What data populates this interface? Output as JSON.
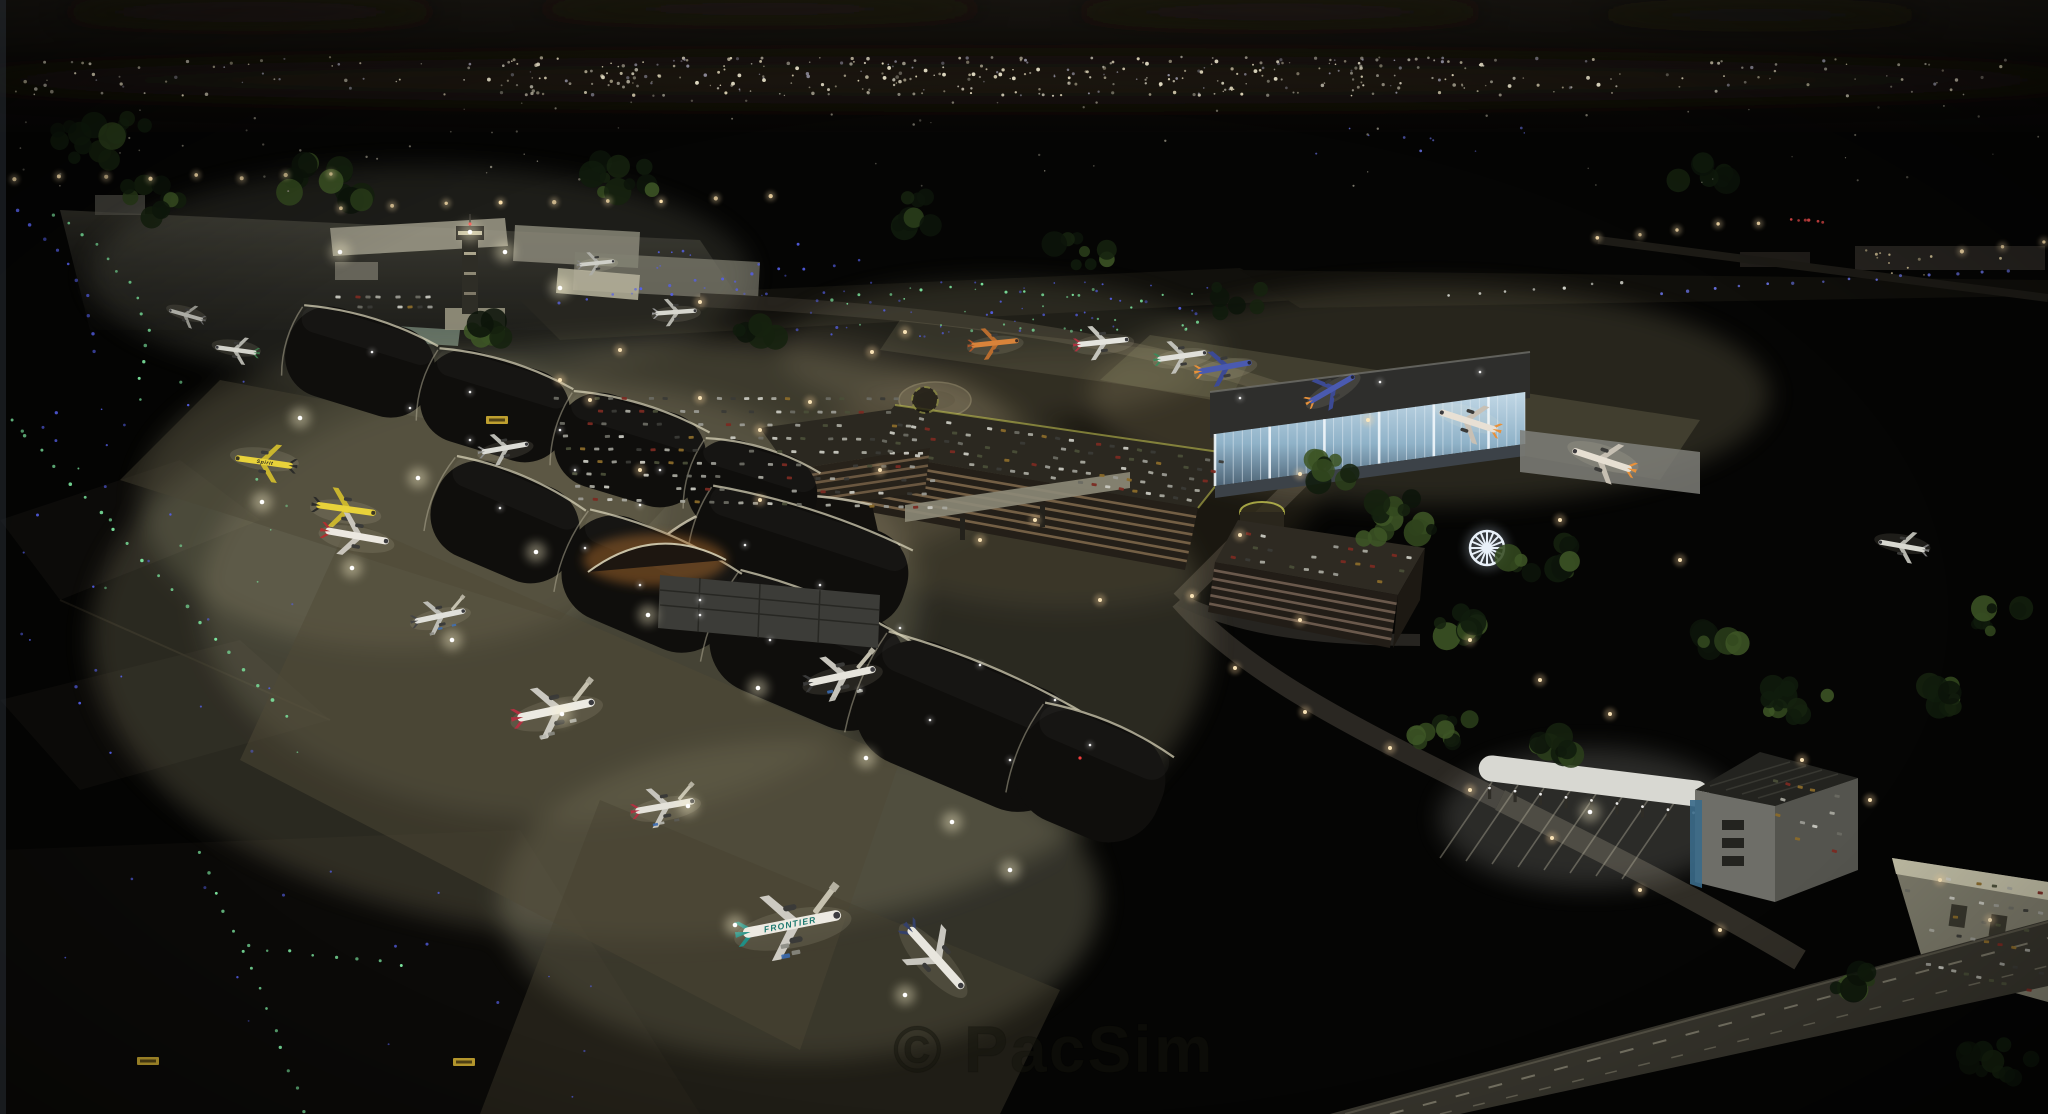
{
  "watermark": {
    "text": "© PacSim"
  },
  "labels": {
    "frontier": "FRONTIER",
    "spirit": "Spirit"
  },
  "palette": {
    "sky_top": "#1b1813",
    "sky": "#0a0907",
    "ground": "#050504",
    "apron_glow": "#d9d2a2",
    "taxi_green": "#7de8a0",
    "taxi_blue": "#5560e8",
    "warm_light": "#ffe3ae",
    "city_warm": "#efe6c8",
    "city_cool": "#b9b5a6",
    "roof_dark": "#0f0e0c",
    "roof_rib": "#d6d0b6",
    "garage_band": "#b5946a",
    "garage_trim": "#c6c650",
    "glass_blue": "#a9c6da",
    "red_light": "#e04848"
  },
  "scene": {
    "city_band": {
      "y_min": 57,
      "y_max": 96,
      "count": 430
    },
    "aircraft": [
      {
        "name": "spirit-a320-remote",
        "x": 264,
        "y": 462,
        "rot": 188,
        "len": 56,
        "body": "#e8d23a",
        "tail": "#2a2a28",
        "wing": "#c9b52e",
        "label": "Spirit",
        "label_color": "#1a1a1a"
      },
      {
        "name": "white-regional-upper",
        "x": 505,
        "y": 448,
        "rot": -10,
        "len": 46,
        "body": "#dcdcd6",
        "tail": "#8a8a88",
        "wing": "#b9b9b2"
      },
      {
        "name": "spirit-a320-gate",
        "x": 346,
        "y": 509,
        "rot": 8,
        "len": 58,
        "body": "#e8d23a",
        "tail": "#2a2a28",
        "wing": "#c9b52e"
      },
      {
        "name": "retro-red-737",
        "x": 357,
        "y": 536,
        "rot": 10,
        "len": 62,
        "body": "#ece8e0",
        "tail": "#b03030",
        "wing": "#c9c5bc"
      },
      {
        "name": "regional-gate-a",
        "x": 440,
        "y": 616,
        "rot": -12,
        "len": 50,
        "body": "#e0e0da",
        "tail": "#444444",
        "wing": "#bdbdb6",
        "bridge": -38
      },
      {
        "name": "delta-737",
        "x": 556,
        "y": 710,
        "rot": -12,
        "len": 76,
        "body": "#eceae2",
        "tail": "#b03040",
        "wing": "#cac8c0",
        "bridge": -40
      },
      {
        "name": "delta-crj",
        "x": 665,
        "y": 806,
        "rot": -10,
        "len": 58,
        "body": "#e4e2da",
        "tail": "#b03040",
        "wing": "#c6c4bc",
        "bridge": -40
      },
      {
        "name": "frontier-a321",
        "x": 792,
        "y": 924,
        "rot": -11,
        "len": 96,
        "body": "#edeae2",
        "tail": "#1f8f86",
        "wing": "#cdcac2",
        "label": "FRONTIER",
        "label_color": "#1e7a70",
        "bridge": -42
      },
      {
        "name": "gate-widebody-dark-tail",
        "x": 842,
        "y": 676,
        "rot": -12,
        "len": 66,
        "body": "#e6e4dc",
        "tail": "#3a3a3a",
        "wing": "#c6c4bc",
        "bridge": -38
      },
      {
        "name": "pushback-jet",
        "x": 936,
        "y": 958,
        "rot": 48,
        "len": 78,
        "body": "#e8e6de",
        "tail": "#34406a",
        "wing": "#c8c6be"
      },
      {
        "name": "cargo-jet-west-1",
        "x": 186,
        "y": 315,
        "rot": 196,
        "len": 34,
        "body": "#b8b8b0",
        "tail": "#666666",
        "wing": "#9a9a92"
      },
      {
        "name": "cargo-jet-west-2",
        "x": 236,
        "y": 350,
        "rot": 188,
        "len": 40,
        "body": "#d4d4cc",
        "tail": "#3a7a4a",
        "wing": "#b2b2aa"
      },
      {
        "name": "remote-jet-north-1",
        "x": 597,
        "y": 263,
        "rot": -6,
        "len": 34,
        "body": "#cfcfc8",
        "tail": "#888888",
        "wing": "#adada6"
      },
      {
        "name": "remote-jet-north-2",
        "x": 676,
        "y": 312,
        "rot": -4,
        "len": 40,
        "body": "#d6d6ce",
        "tail": "#999999",
        "wing": "#b4b4ac"
      },
      {
        "name": "southwest-gold-737",
        "x": 995,
        "y": 343,
        "rot": -6,
        "len": 46,
        "body": "#d8833a",
        "tail": "#a8542a",
        "wing": "#b86c2e"
      },
      {
        "name": "delta-a320-east",
        "x": 1103,
        "y": 342,
        "rot": -6,
        "len": 50,
        "body": "#e4e4de",
        "tail": "#b03040",
        "wing": "#c4c4bc"
      },
      {
        "name": "green-tail-jet",
        "x": 1182,
        "y": 356,
        "rot": -8,
        "len": 48,
        "body": "#e0e0da",
        "tail": "#3a8a5a",
        "wing": "#c0c0b8"
      },
      {
        "name": "southwest-737-blue-1",
        "x": 1225,
        "y": 367,
        "rot": -10,
        "len": 52,
        "body": "#4a5ab0",
        "tail": "#e8913a",
        "wing": "#3c4a94"
      },
      {
        "name": "southwest-737-blue-2",
        "x": 1332,
        "y": 389,
        "rot": -30,
        "len": 50,
        "body": "#4a5ab0",
        "tail": "#e8913a",
        "wing": "#3c4a94"
      },
      {
        "name": "southwest-737-white-1",
        "x": 1468,
        "y": 421,
        "rot": 198,
        "len": 58,
        "body": "#e8e0d4",
        "tail": "#e8913a",
        "wing": "#c8c0b4"
      },
      {
        "name": "southwest-737-white-2",
        "x": 1602,
        "y": 460,
        "rot": 198,
        "len": 60,
        "body": "#e6dfd2",
        "tail": "#e8913a",
        "wing": "#c6bfb2"
      },
      {
        "name": "remote-jet-east",
        "x": 1902,
        "y": 546,
        "rot": 190,
        "len": 46,
        "body": "#d8d8d0",
        "tail": "#777777",
        "wing": "#b6b6ae"
      }
    ],
    "light_chains": [
      {
        "color": "#7de8a0",
        "r": 1.3,
        "n": 13,
        "pts": [
          [
            55,
            215
          ],
          [
            95,
            245
          ],
          [
            132,
            286
          ],
          [
            148,
            330
          ],
          [
            140,
            378
          ]
        ]
      },
      {
        "color": "#5560e8",
        "r": 1.3,
        "n": 10,
        "pts": [
          [
            18,
            212
          ],
          [
            58,
            252
          ],
          [
            88,
            300
          ],
          [
            94,
            350
          ]
        ]
      },
      {
        "color": "#7de8a0",
        "r": 1.4,
        "n": 20,
        "pts": [
          [
            12,
            420
          ],
          [
            58,
            470
          ],
          [
            118,
            532
          ],
          [
            170,
            588
          ],
          [
            228,
            652
          ],
          [
            288,
            716
          ]
        ]
      },
      {
        "color": "#7de8a0",
        "r": 1.3,
        "n": 14,
        "pts": [
          [
            200,
            852
          ],
          [
            222,
            906
          ],
          [
            248,
            962
          ],
          [
            268,
            1012
          ],
          [
            288,
            1066
          ],
          [
            302,
            1110
          ]
        ]
      },
      {
        "color": "#7de8a0",
        "r": 1.2,
        "n": 8,
        "pts": [
          [
            247,
            947
          ],
          [
            330,
            956
          ],
          [
            402,
            964
          ]
        ]
      },
      {
        "color": "#5560e8",
        "r": 1.2,
        "n": 12,
        "pts": [
          [
            560,
            302
          ],
          [
            660,
            288
          ],
          [
            760,
            272
          ],
          [
            860,
            262
          ]
        ]
      },
      {
        "color": "#7de8a0",
        "r": 1.2,
        "n": 6,
        "pts": [
          [
            830,
            300
          ],
          [
            900,
            292
          ],
          [
            980,
            286
          ]
        ]
      },
      {
        "color": "#6a74e8",
        "r": 1.2,
        "n": 14,
        "pts": [
          [
            1660,
            292
          ],
          [
            1780,
            284
          ],
          [
            1900,
            277
          ],
          [
            2010,
            270
          ]
        ]
      },
      {
        "color": "#cfd0c8",
        "r": 1.2,
        "n": 7,
        "pts": [
          [
            1450,
            295
          ],
          [
            1540,
            289
          ],
          [
            1620,
            284
          ]
        ]
      },
      {
        "color": "#e04848",
        "r": 1.2,
        "n": 6,
        "pts": [
          [
            1793,
            219
          ],
          [
            1822,
            221
          ]
        ]
      },
      {
        "color": "#ffe3ae",
        "r": 1.7,
        "n": 8,
        "glow": true,
        "pts": [
          [
            15,
            178
          ],
          [
            330,
            176
          ]
        ]
      },
      {
        "color": "#ffe3ae",
        "r": 1.7,
        "n": 9,
        "glow": true,
        "pts": [
          [
            340,
            207
          ],
          [
            770,
            197
          ]
        ]
      },
      {
        "color": "#ffe3ae",
        "r": 1.6,
        "n": 5,
        "glow": true,
        "pts": [
          [
            1598,
            237
          ],
          [
            1760,
            222
          ]
        ]
      },
      {
        "color": "#ffe3ae",
        "r": 1.6,
        "n": 3,
        "glow": true,
        "pts": [
          [
            1960,
            252
          ],
          [
            2042,
            242
          ]
        ]
      }
    ],
    "scatter_fields": [
      {
        "x": 8,
        "y": 380,
        "w": 290,
        "h": 380,
        "n": 26,
        "color": "#5560e8",
        "r": 1.2
      },
      {
        "x": 8,
        "y": 380,
        "w": 290,
        "h": 380,
        "n": 12,
        "color": "#7de8a0",
        "r": 1.2
      },
      {
        "x": 790,
        "y": 282,
        "w": 420,
        "h": 55,
        "n": 45,
        "color": "#5560e8",
        "r": 1.1
      },
      {
        "x": 820,
        "y": 284,
        "w": 390,
        "h": 50,
        "n": 34,
        "color": "#7de8a0",
        "r": 1.1
      },
      {
        "x": 620,
        "y": 236,
        "w": 180,
        "h": 60,
        "n": 18,
        "color": "#5560e8",
        "r": 1.1
      },
      {
        "x": 0,
        "y": 100,
        "w": 2048,
        "h": 92,
        "n": 72,
        "color": "#8a8678",
        "r": 0.9
      },
      {
        "x": 40,
        "y": 860,
        "w": 560,
        "h": 240,
        "n": 16,
        "color": "#5560e8",
        "r": 1.1
      },
      {
        "x": 1865,
        "y": 250,
        "w": 175,
        "h": 26,
        "n": 12,
        "color": "#e0cfa0",
        "r": 1.1
      },
      {
        "x": 1240,
        "y": 118,
        "w": 300,
        "h": 40,
        "n": 10,
        "color": "#6a74e8",
        "r": 1.0
      }
    ],
    "street_lights": [
      [
        872,
        352
      ],
      [
        905,
        332
      ],
      [
        700,
        302
      ],
      [
        1368,
        420
      ],
      [
        1300,
        474
      ],
      [
        1240,
        535
      ],
      [
        1192,
        596
      ],
      [
        1235,
        668
      ],
      [
        1305,
        712
      ],
      [
        1390,
        748
      ],
      [
        1470,
        790
      ],
      [
        1552,
        838
      ],
      [
        1640,
        890
      ],
      [
        1720,
        930
      ],
      [
        1470,
        640
      ],
      [
        1540,
        680
      ],
      [
        1610,
        714
      ],
      [
        1680,
        560
      ],
      [
        1560,
        520
      ],
      [
        1300,
        620
      ],
      [
        620,
        350
      ],
      [
        560,
        380
      ],
      [
        760,
        430
      ],
      [
        980,
        540
      ],
      [
        590,
        400
      ],
      [
        700,
        398
      ],
      [
        810,
        402
      ],
      [
        880,
        470
      ],
      [
        640,
        470
      ],
      [
        760,
        500
      ],
      [
        1940,
        880
      ],
      [
        1990,
        920
      ],
      [
        1802,
        760
      ],
      [
        1870,
        800
      ],
      [
        1100,
        600
      ],
      [
        1035,
        520
      ]
    ],
    "floodlights": [
      [
        300,
        418
      ],
      [
        418,
        478
      ],
      [
        536,
        552
      ],
      [
        648,
        615
      ],
      [
        758,
        688
      ],
      [
        866,
        758
      ],
      [
        952,
        822
      ],
      [
        1010,
        870
      ],
      [
        262,
        502
      ],
      [
        352,
        568
      ],
      [
        452,
        640
      ],
      [
        562,
        714
      ],
      [
        688,
        806
      ],
      [
        905,
        995
      ],
      [
        735,
        925
      ],
      [
        470,
        232
      ],
      [
        340,
        252
      ],
      [
        505,
        252
      ],
      [
        560,
        288
      ],
      [
        1590,
        812
      ]
    ],
    "roof_lights": [
      [
        372,
        352
      ],
      [
        470,
        392
      ],
      [
        560,
        430
      ],
      [
        660,
        470
      ],
      [
        500,
        508
      ],
      [
        585,
        548
      ],
      [
        700,
        600
      ],
      [
        770,
        640
      ],
      [
        860,
        690
      ],
      [
        930,
        720
      ],
      [
        1010,
        760
      ],
      [
        575,
        470
      ],
      [
        640,
        505
      ],
      [
        745,
        545
      ],
      [
        820,
        585
      ],
      [
        900,
        628
      ],
      [
        980,
        665
      ],
      [
        1055,
        700
      ],
      [
        470,
        440
      ],
      [
        410,
        408
      ],
      [
        1090,
        745
      ],
      [
        640,
        585
      ],
      [
        700,
        615
      ],
      [
        1240,
        398
      ],
      [
        1380,
        382
      ],
      [
        1480,
        372
      ]
    ],
    "parking_lots": [
      {
        "quad": [
          [
            548,
            392
          ],
          [
            900,
            392
          ],
          [
            955,
            515
          ],
          [
            575,
            505
          ]
        ],
        "rows": 9,
        "cols": 26,
        "skip": 0.25
      },
      {
        "quad": [
          [
            905,
            412
          ],
          [
            1232,
            458
          ],
          [
            1192,
            506
          ],
          [
            866,
            452
          ]
        ],
        "rows": 5,
        "cols": 24,
        "skip": 0.3
      },
      {
        "quad": [
          [
            1245,
            527
          ],
          [
            1420,
            552
          ],
          [
            1398,
            592
          ],
          [
            1222,
            562
          ]
        ],
        "rows": 3,
        "cols": 12,
        "skip": 0.35
      },
      {
        "quad": [
          [
            1892,
            862
          ],
          [
            2048,
            884
          ],
          [
            2048,
            1005
          ],
          [
            1925,
            972
          ]
        ],
        "rows": 6,
        "cols": 10,
        "skip": 0.5
      },
      {
        "quad": [
          [
            332,
            292
          ],
          [
            432,
            292
          ],
          [
            436,
            312
          ],
          [
            336,
            312
          ]
        ],
        "rows": 2,
        "cols": 10,
        "skip": 0.3
      },
      {
        "quad": [
          [
            1772,
            772
          ],
          [
            1858,
            792
          ],
          [
            1838,
            862
          ],
          [
            1752,
            832
          ]
        ],
        "rows": 4,
        "cols": 7,
        "skip": 0.45
      }
    ],
    "trees": [
      {
        "x": 1395,
        "y": 520,
        "n": 14,
        "s": 80,
        "lit": 0.5
      },
      {
        "x": 1540,
        "y": 560,
        "n": 12,
        "s": 64,
        "lit": 0.4
      },
      {
        "x": 1460,
        "y": 625,
        "n": 10,
        "s": 54,
        "lit": 0.3
      },
      {
        "x": 1445,
        "y": 735,
        "n": 12,
        "s": 58,
        "lit": 0.5
      },
      {
        "x": 1560,
        "y": 745,
        "n": 10,
        "s": 48,
        "lit": 0.4
      },
      {
        "x": 1800,
        "y": 700,
        "n": 12,
        "s": 64,
        "lit": 0.45
      },
      {
        "x": 1950,
        "y": 700,
        "n": 10,
        "s": 54,
        "lit": 0.35
      },
      {
        "x": 2000,
        "y": 620,
        "n": 8,
        "s": 48,
        "lit": 0.3
      },
      {
        "x": 1720,
        "y": 640,
        "n": 8,
        "s": 44,
        "lit": 0.35
      },
      {
        "x": 1850,
        "y": 980,
        "n": 8,
        "s": 44,
        "lit": 0.3
      },
      {
        "x": 2000,
        "y": 1060,
        "n": 12,
        "s": 70,
        "lit": 0.1
      },
      {
        "x": 330,
        "y": 185,
        "n": 12,
        "s": 86,
        "lit": 0.35
      },
      {
        "x": 150,
        "y": 200,
        "n": 10,
        "s": 64,
        "lit": 0.3
      },
      {
        "x": 620,
        "y": 175,
        "n": 10,
        "s": 74,
        "lit": 0.25
      },
      {
        "x": 900,
        "y": 210,
        "n": 8,
        "s": 64,
        "lit": 0.2
      },
      {
        "x": 1080,
        "y": 250,
        "n": 8,
        "s": 54,
        "lit": 0.2
      },
      {
        "x": 760,
        "y": 330,
        "n": 6,
        "s": 42,
        "lit": 0.4
      },
      {
        "x": 1330,
        "y": 470,
        "n": 8,
        "s": 42,
        "lit": 0.4
      },
      {
        "x": 1240,
        "y": 300,
        "n": 6,
        "s": 52,
        "lit": 0.15
      },
      {
        "x": 480,
        "y": 330,
        "n": 6,
        "s": 42,
        "lit": 0.35
      },
      {
        "x": 100,
        "y": 140,
        "n": 14,
        "s": 90,
        "lit": 0.1
      },
      {
        "x": 1700,
        "y": 170,
        "n": 7,
        "s": 56,
        "lit": 0.08
      }
    ],
    "signs": [
      [
        137,
        1057
      ],
      [
        453,
        1058
      ],
      [
        486,
        416
      ]
    ],
    "red_beacons": [
      [
        470,
        224
      ],
      [
        1080,
        758
      ]
    ]
  }
}
